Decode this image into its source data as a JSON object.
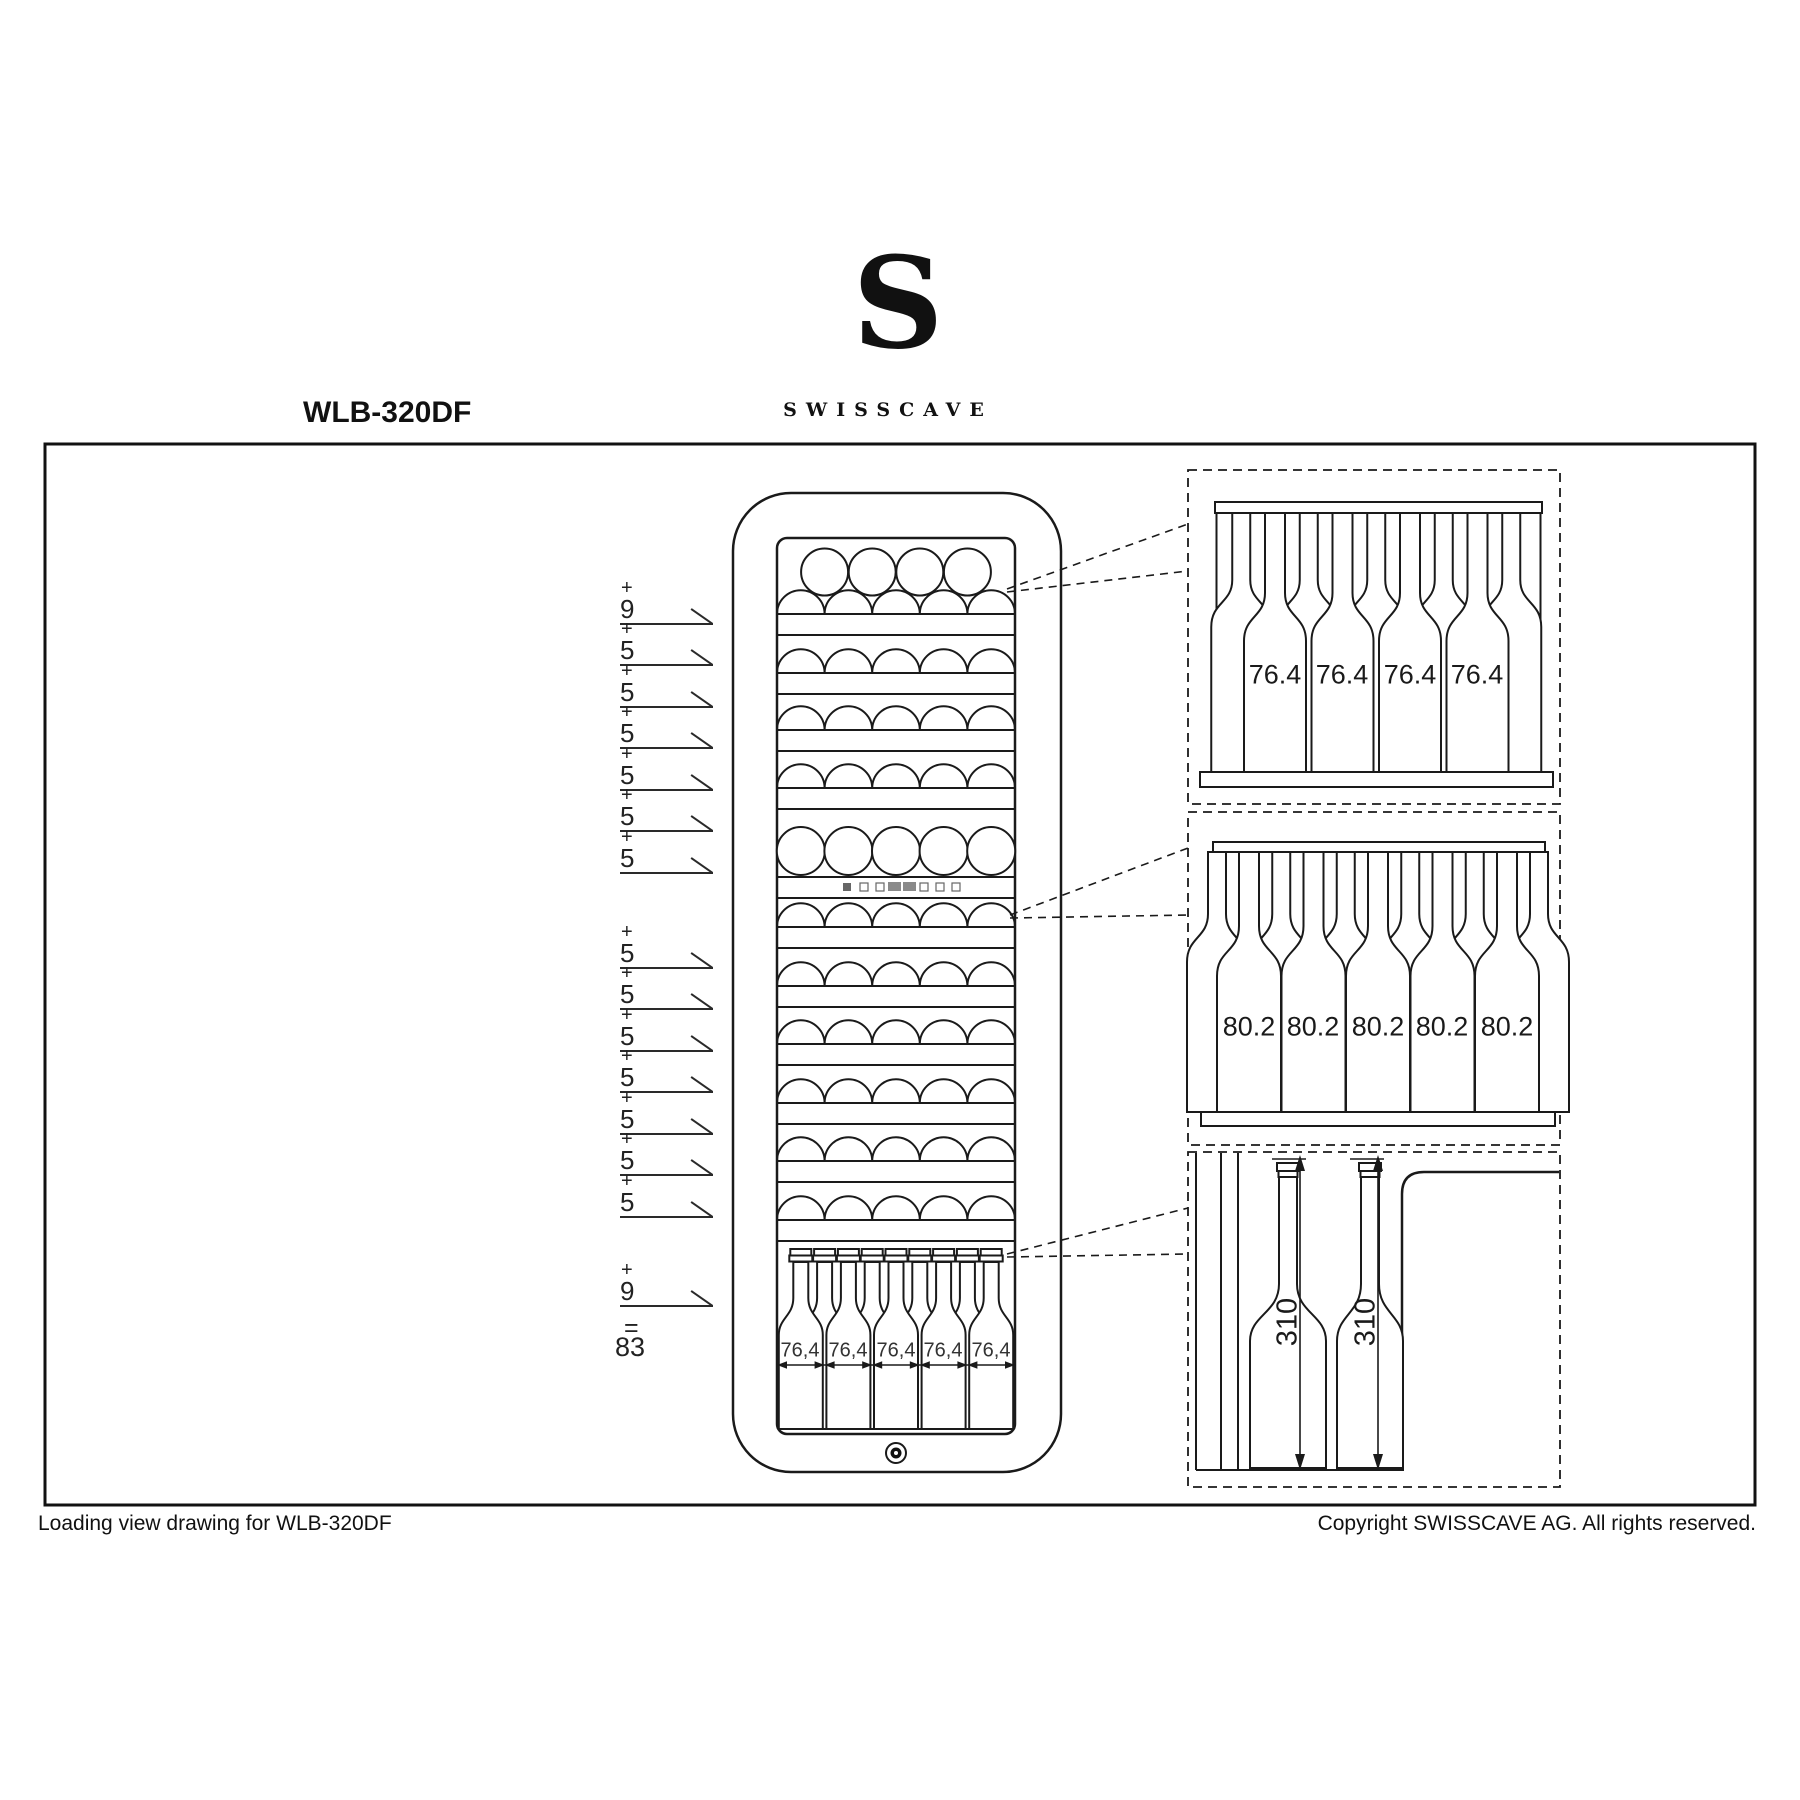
{
  "page": {
    "background": "#ffffff",
    "line_color": "#1a1a1a"
  },
  "header": {
    "model": "WLB-320DF",
    "monogram": "S",
    "wordmark": "SWISSCAVE"
  },
  "tally": {
    "plus": "+",
    "equals_sign": "=",
    "total": "83",
    "group1": [
      "9",
      "5",
      "5",
      "5",
      "5",
      "5",
      "5"
    ],
    "group2": [
      "5",
      "5",
      "5",
      "5",
      "5",
      "5",
      "5"
    ],
    "final": "9"
  },
  "cabinet": {
    "bottom_row_widths": [
      "76,4",
      "76,4",
      "76,4",
      "76,4",
      "76,4"
    ]
  },
  "details": {
    "top_shelf_widths": [
      "76.4",
      "76.4",
      "76.4",
      "76.4"
    ],
    "middle_shelf_widths": [
      "80.2",
      "80.2",
      "80.2",
      "80.2",
      "80.2"
    ],
    "door_bottle_heights": [
      "310",
      "310"
    ]
  },
  "footer": {
    "left": "Loading view drawing for WLB-320DF",
    "right": "Copyright SWISSCAVE AG. All rights reserved."
  }
}
